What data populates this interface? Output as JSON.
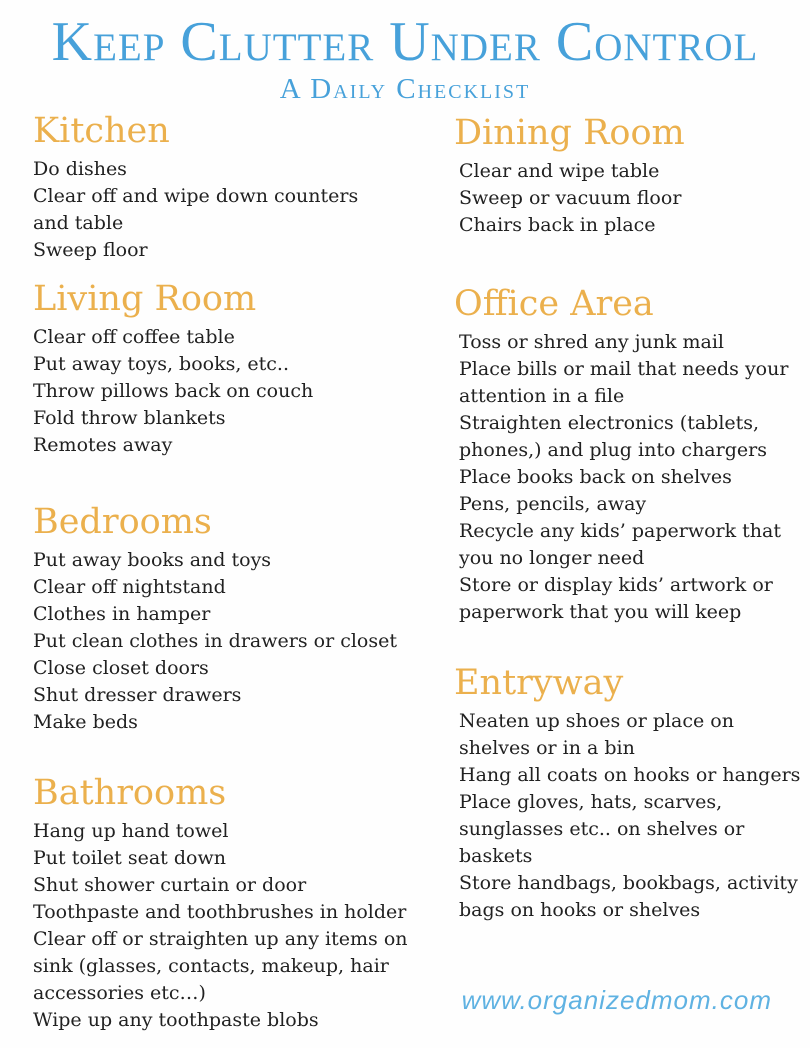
{
  "header": {
    "title": "Keep Clutter Under Control",
    "subtitle": "A Daily Checklist"
  },
  "columns": {
    "left": [
      {
        "heading": "Kitchen",
        "items": [
          "Do dishes",
          "Clear off and wipe down counters\nand table",
          "Sweep floor"
        ]
      },
      {
        "heading": "Living Room",
        "items": [
          "Clear off coffee table",
          "Put away toys, books, etc..",
          "Throw pillows back on couch",
          "Fold throw blankets",
          "Remotes away"
        ]
      },
      {
        "heading": "Bedrooms",
        "items": [
          "Put away books and toys",
          "Clear off nightstand",
          "Clothes in hamper",
          "Put clean clothes in drawers or closet",
          "Close closet doors",
          "Shut dresser drawers",
          "Make beds"
        ]
      },
      {
        "heading": "Bathrooms",
        "items": [
          "Hang up hand towel",
          "Put toilet seat down",
          "Shut shower curtain or door",
          "Toothpaste and toothbrushes in holder",
          "Clear off or straighten up any items on\nsink (glasses, contacts, makeup, hair\naccessories etc…)",
          "Wipe up any toothpaste blobs"
        ]
      }
    ],
    "right": [
      {
        "heading": "Dining Room",
        "items": [
          "Clear and wipe table",
          "Sweep or vacuum floor",
          "Chairs back in place"
        ]
      },
      {
        "heading": "Office Area",
        "items": [
          "Toss or shred any junk mail",
          "Place bills or mail that needs your\nattention in a file",
          "Straighten electronics (tablets,\nphones,) and plug into chargers",
          "Place books back on shelves",
          "Pens, pencils, away",
          "Recycle any kids’ paperwork that\nyou no longer need",
          "Store or display kids’ artwork or\npaperwork that you will keep"
        ]
      },
      {
        "heading": "Entryway",
        "items": [
          "Neaten up shoes or place on\nshelves or in a bin",
          "Hang all coats on hooks or hangers",
          "Place gloves, hats, scarves,\nsunglasses etc.. on shelves or\nbaskets",
          "Store handbags, bookbags, activity\nbags on hooks or shelves"
        ]
      }
    ]
  },
  "footer": {
    "url": "www.organizedmom.com"
  },
  "colors": {
    "title_blue": "#47a1da",
    "heading_gold": "#ebb04d",
    "body_text": "#212121",
    "footer_blue": "#5fb2e2",
    "background": "#fefefe"
  }
}
